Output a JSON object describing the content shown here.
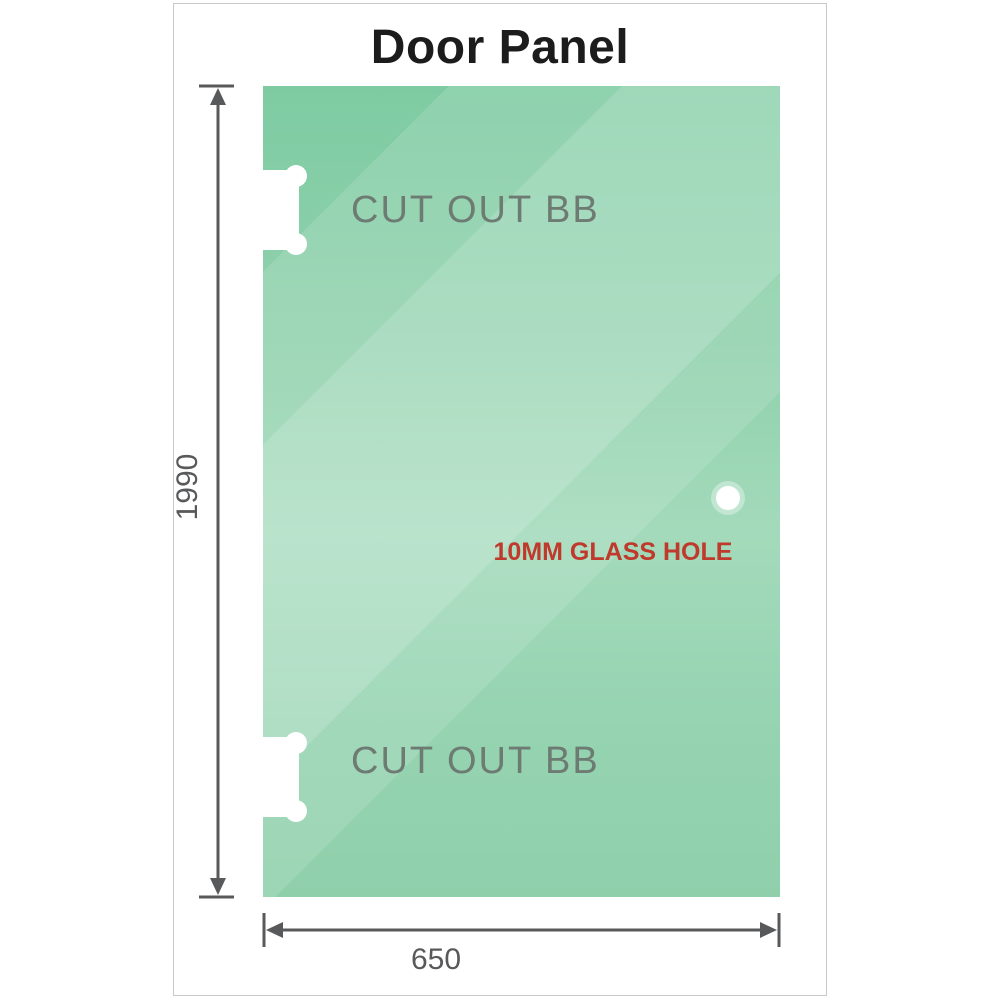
{
  "title": "Door Panel",
  "panel": {
    "cutout_top": {
      "label": "CUT OUT BB"
    },
    "cutout_bottom": {
      "label": "CUT OUT BB"
    },
    "glass_hole": {
      "label": "10MM GLASS HOLE"
    }
  },
  "dimensions": {
    "height": {
      "value": "1990"
    },
    "width": {
      "value": "650"
    }
  },
  "colors": {
    "glass-dark": "#7ecba2",
    "glass-mid": "#a3dabb",
    "glass-bottom": "#8fd0ab",
    "dimension": "#58595b",
    "hole-label": "#bf3a2d",
    "cutout-label": "#6d7b72",
    "title-color": "#1c1c1c",
    "frame-border": "#c9c9c9"
  }
}
